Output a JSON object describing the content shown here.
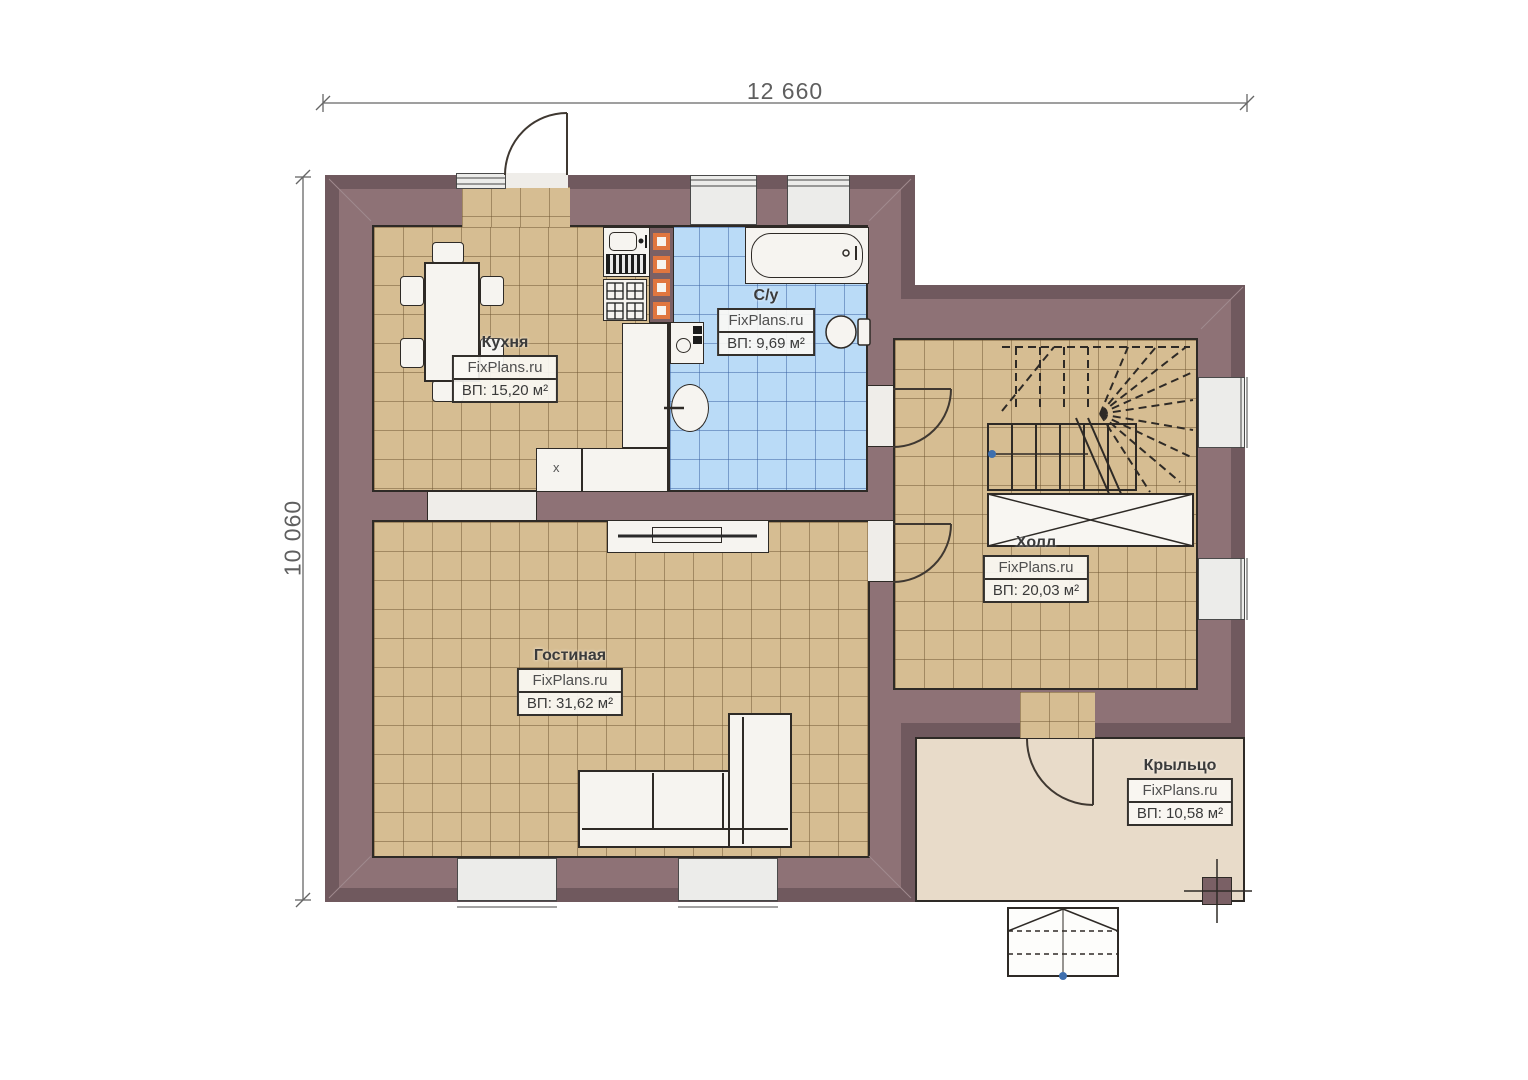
{
  "plan": {
    "dimensions": {
      "width_label": "12 660",
      "height_label": "10 060"
    },
    "rooms": {
      "kitchen": {
        "name": "Кухня",
        "brand": "FixPlans.ru",
        "area": "ВП: 15,20 м²"
      },
      "bathroom": {
        "name": "С/у",
        "brand": "FixPlans.ru",
        "area": "ВП: 9,69 м²"
      },
      "hall": {
        "name": "Холл",
        "brand": "FixPlans.ru",
        "area": "ВП: 20,03 м²"
      },
      "living": {
        "name": "Гостиная",
        "brand": "FixPlans.ru",
        "area": "ВП: 31,62 м²"
      },
      "porch": {
        "name": "Крыльцо",
        "brand": "FixPlans.ru",
        "area": "ВП: 10,58 м²"
      }
    },
    "labels": {
      "kitchen_unit": "x"
    },
    "colors": {
      "wall": "#8e7276",
      "wall_dark": "#70595e",
      "floor_tan": "#d6bd92",
      "floor_tile_blue": "#badbf7",
      "porch": "#e8dbc9",
      "vent_accent": "#e0763f",
      "outline": "#2e2a26",
      "dim_text": "#5f5f5f"
    }
  }
}
